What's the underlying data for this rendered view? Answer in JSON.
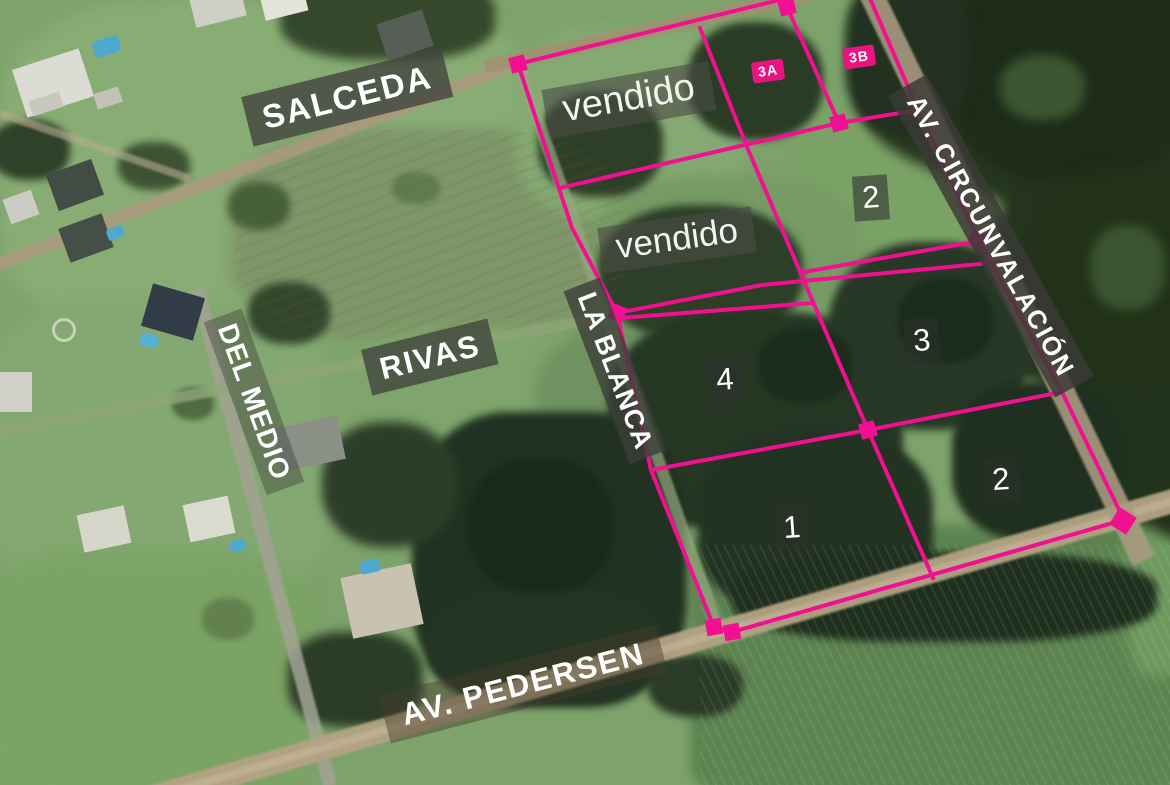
{
  "map": {
    "title": "aerial lot plan",
    "streets": {
      "salceda": "SALCEDA",
      "del_medio": "DEL MEDIO",
      "rivas": "RIVAS",
      "la_blanca": "LA BLANCA",
      "av_circunvalacion": "AV. CIRCUNVALACIÓN",
      "av_pedersen": "AV. PEDERSEN"
    },
    "lots": {
      "sold_label_top": "vendido",
      "sold_label_bottom": "vendido",
      "badge_3a": "3A",
      "badge_3b": "3B",
      "lot_2_top": "2",
      "lot_3": "3",
      "lot_4": "4",
      "lot_1": "1",
      "lot_2_bottom": "2"
    },
    "colors": {
      "boundary_pink": "#F1108F",
      "badge_pink": "#EA1480",
      "label_band_gray": "rgba(64,66,60,0.8)",
      "label_text": "#FFFFFF"
    }
  }
}
